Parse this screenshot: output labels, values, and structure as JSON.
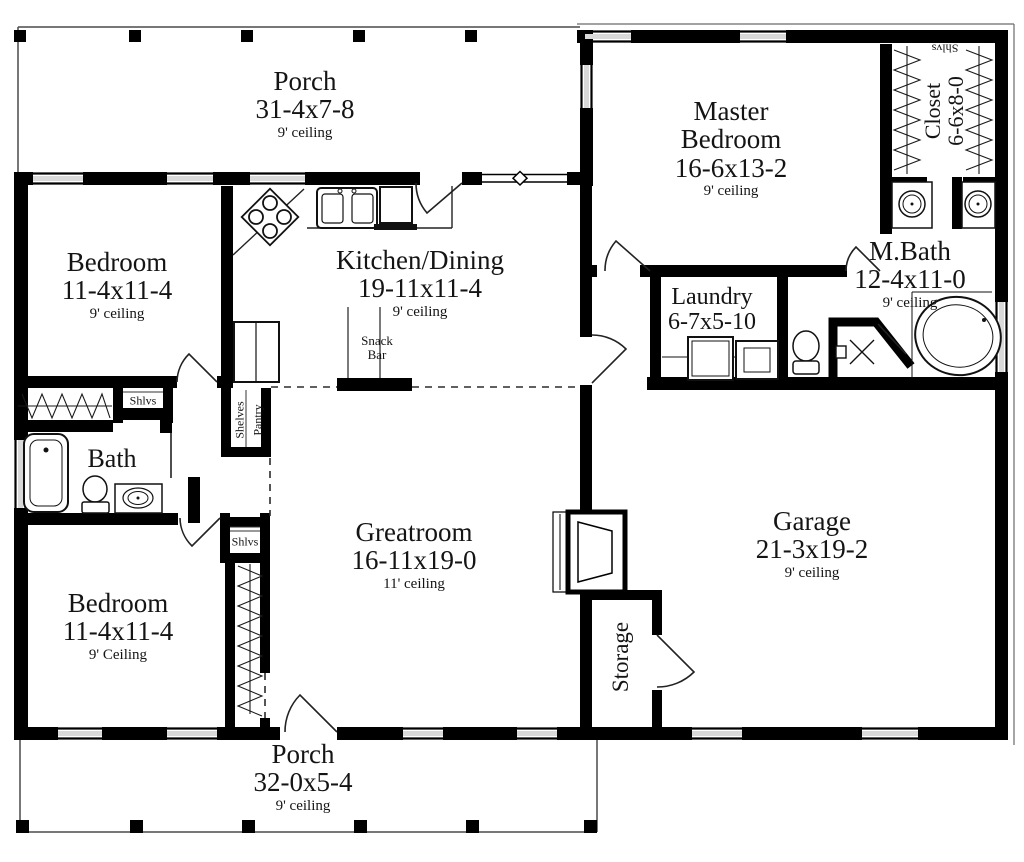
{
  "plan": {
    "rooms": {
      "porch_top": {
        "name": "Porch",
        "dims": "31-4x7-8",
        "ceiling": "9' ceiling"
      },
      "bedroom_upper": {
        "name": "Bedroom",
        "dims": "11-4x11-4",
        "ceiling": "9' ceiling"
      },
      "kitchen": {
        "name": "Kitchen/Dining",
        "dims": "19-11x11-4",
        "ceiling": "9' ceiling"
      },
      "master_bedroom": {
        "name": "Master Bedroom",
        "dims": "16-6x13-2",
        "ceiling": "9' ceiling"
      },
      "closet_master": {
        "name": "Closet",
        "dims": "6-6x8-0"
      },
      "mbath": {
        "name": "M.Bath",
        "dims": "12-4x11-0",
        "ceiling": "9' ceiling"
      },
      "laundry": {
        "name": "Laundry",
        "dims": "6-7x5-10"
      },
      "bath": {
        "name": "Bath"
      },
      "bedroom_lower": {
        "name": "Bedroom",
        "dims": "11-4x11-4",
        "ceiling": "9' Ceiling"
      },
      "greatroom": {
        "name": "Greatroom",
        "dims": "16-11x19-0",
        "ceiling": "11' ceiling"
      },
      "storage": {
        "name": "Storage"
      },
      "garage": {
        "name": "Garage",
        "dims": "21-3x19-2",
        "ceiling": "9' ceiling"
      },
      "porch_bottom": {
        "name": "Porch",
        "dims": "32-0x5-4",
        "ceiling": "9' ceiling"
      }
    },
    "annotations": {
      "snack_line1": "Snack",
      "snack_line2": "Bar",
      "shelves": "Shelves",
      "pantry": "Pantry",
      "shlvs_master": "Shlvs",
      "shlvs_bath": "Shlvs",
      "shlvs_hall": "Shlvs"
    },
    "colors": {
      "wall": "#000000",
      "text": "#141414",
      "window_fill": "#d9d9d9",
      "background": "#ffffff"
    }
  }
}
